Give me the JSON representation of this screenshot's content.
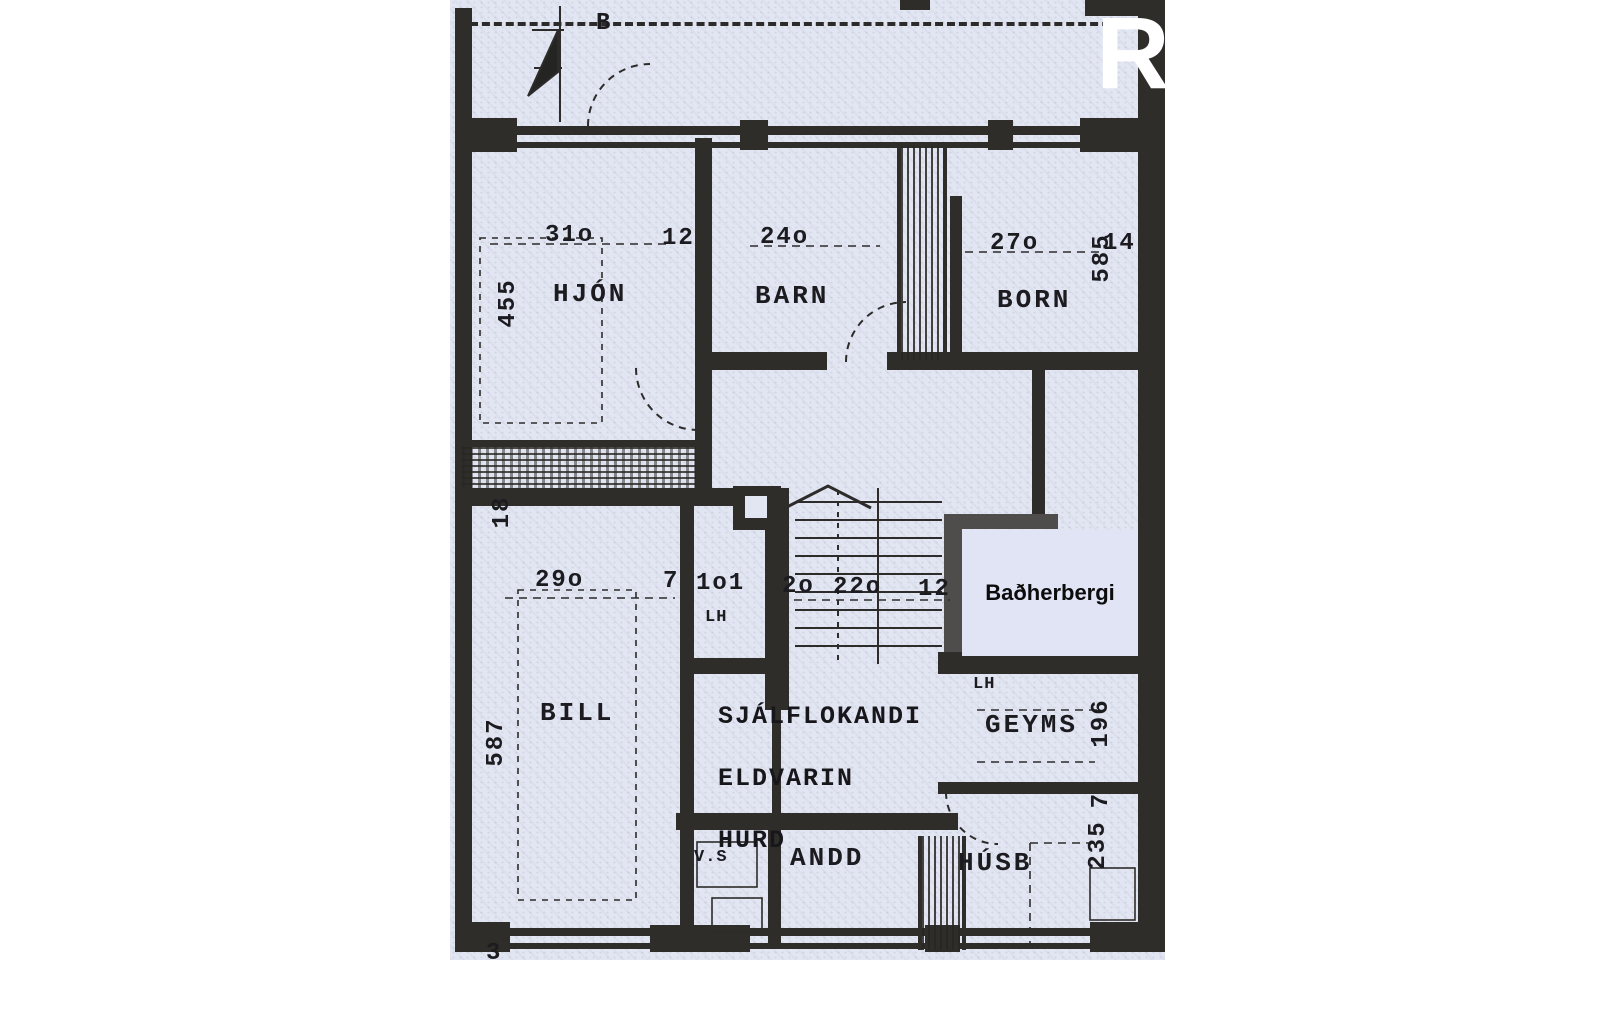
{
  "page": {
    "background": "#ffffff"
  },
  "watermark": {
    "letter": "R",
    "color": "#ffffff"
  },
  "plan": {
    "paper_color": "#e2e5f2",
    "ink_color": "#2f2d2a",
    "compass_label": "B",
    "rooms": [
      {
        "label": "HJÓN"
      },
      {
        "label": "BARN"
      },
      {
        "label": "BORN"
      },
      {
        "label": "BILL"
      },
      {
        "label": "GEYMS"
      },
      {
        "label": "V.S"
      },
      {
        "label": "ANDD"
      },
      {
        "label": "HÚSB"
      },
      {
        "label": "LH"
      },
      {
        "label": "LH"
      },
      {
        "label": "Baðherbergi"
      }
    ],
    "fire_door_note": {
      "line1": "SJÁLFLOKANDI",
      "line2": "ELDVARIN",
      "line3": "HURD"
    },
    "dims": [
      {
        "text": "31o"
      },
      {
        "text": "12"
      },
      {
        "text": "455"
      },
      {
        "text": "24o"
      },
      {
        "text": "27o"
      },
      {
        "text": "585"
      },
      {
        "text": "14"
      },
      {
        "text": "18"
      },
      {
        "text": "29o"
      },
      {
        "text": "7"
      },
      {
        "text": "1o1"
      },
      {
        "text": "2o"
      },
      {
        "text": "22o"
      },
      {
        "text": "12"
      },
      {
        "text": "587"
      },
      {
        "text": "196"
      },
      {
        "text": "7"
      },
      {
        "text": "235"
      },
      {
        "text": "3"
      }
    ]
  }
}
